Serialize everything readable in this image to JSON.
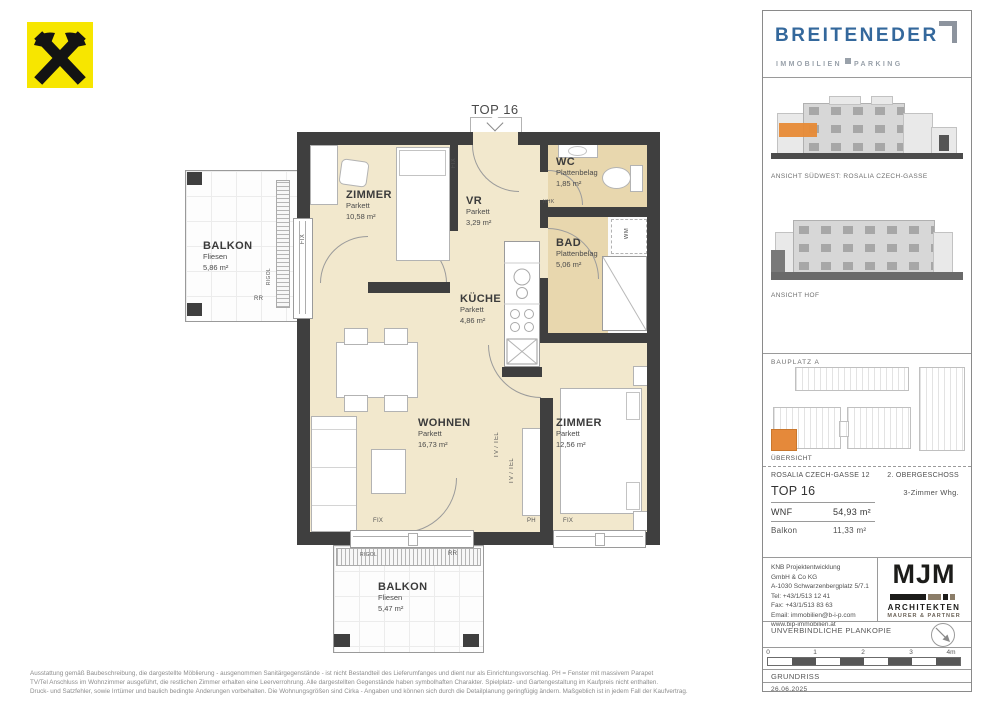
{
  "plan": {
    "unit_label": "TOP 16",
    "rooms": {
      "zimmer1": {
        "name": "ZIMMER",
        "floor": "Parkett",
        "area": "10,58 m²"
      },
      "vr": {
        "name": "VR",
        "floor": "Parkett",
        "area": "3,29 m²"
      },
      "wc": {
        "name": "WC",
        "floor": "Plattenbelag",
        "area": "1,85 m²"
      },
      "bad": {
        "name": "BAD",
        "floor": "Plattenbelag",
        "area": "5,06 m²"
      },
      "kueche": {
        "name": "KÜCHE",
        "floor": "Parkett",
        "area": "4,86 m²"
      },
      "wohnen": {
        "name": "WOHNEN",
        "floor": "Parkett",
        "area": "16,73 m²"
      },
      "zimmer2": {
        "name": "ZIMMER",
        "floor": "Parkett",
        "area": "12,56 m²"
      },
      "balkon_west": {
        "name": "BALKON",
        "floor": "Fliesen",
        "area": "5,86 m²"
      },
      "balkon_sued": {
        "name": "BALKON",
        "floor": "Fliesen",
        "area": "5,47 m²"
      }
    },
    "tags": {
      "fix": "FIX",
      "ph": "PH",
      "tv_tel": "TV / TEL",
      "hhk": "HHK",
      "wm": "WM",
      "rigol": "RIGOL",
      "rr": "RR"
    }
  },
  "sidebar": {
    "brand": {
      "name": "BREITENEDER",
      "sub_left": "IMMOBILIEN",
      "sub_right": "PARKING"
    },
    "views": [
      {
        "caption": "ANSICHT SÜDWEST: ROSALIA CZECH-GASSE"
      },
      {
        "caption": "ANSICHT HOF"
      }
    ],
    "siteplan": {
      "top_label": "BAUPLATZ  A",
      "bottom_label": "ÜBERSICHT"
    },
    "info": {
      "address": "ROSALIA CZECH-GASSE 12",
      "floor": "2. OBERGESCHOSS",
      "unit": "TOP 16",
      "unit_type": "3-Zimmer Whg.",
      "rows": [
        {
          "label": "WNF",
          "value": "54,93 m²"
        },
        {
          "label": "Balkon",
          "value": "11,33 m²"
        }
      ]
    },
    "developer": {
      "lines": [
        "KNB Projektentwicklung",
        "GmbH & Co KG",
        "A-1030 Schwarzenbergplatz 5/7.1",
        "Tel: +43/1/513 12 41",
        "Fax: +43/1/513 83 63",
        "Email: immobilien@b-i-p.com",
        "www.bip-immobilien.at"
      ]
    },
    "architect": {
      "logo": "MJM",
      "line1": "ARCHITEKTEN",
      "line2": "MAURER & PARTNER"
    },
    "plan_copy_note": "UNVERBINDLICHE PLANKOPIE",
    "scale": {
      "ticks": [
        "0",
        "1",
        "2",
        "3",
        "4m"
      ]
    },
    "drawing_type": "GRUNDRISS",
    "date": "26.06.2025"
  },
  "disclaimer": {
    "line1": "Ausstattung gemäß Baubeschreibung, die dargestellte Möblierung - ausgenommen Sanitärgegenstände - ist nicht Bestandteil des Lieferumfanges und dient nur als Einrichtungsvorschlag. PH = Fenster mit massivem Parapet",
    "line2": "TV/Tel Anschluss im Wohnzimmer ausgeführt, die restlichen Zimmer erhalten eine Leerverrohrung. Alle dargestellten Gegenstände haben symbolhaften Charakter. Spielplatz- und Gartengestaltung im Kaufpreis nicht enthalten.",
    "line3": "Druck- und Satzfehler, sowie Irrtümer und baulich bedingte Änderungen vorbehalten. Die Wohnungsgrößen sind Cirka - Angaben und können sich durch die Detailplanung geringfügig ändern. Maßgeblich ist in jedem Fall der Kaufvertrag."
  },
  "colors": {
    "wall": "#3f3f3f",
    "floor_cream": "#f2e8cd",
    "floor_tan": "#e8d7ae",
    "accent_orange": "#e5893a",
    "brand_blue": "#34689c",
    "logo_yellow": "#f7e600"
  }
}
